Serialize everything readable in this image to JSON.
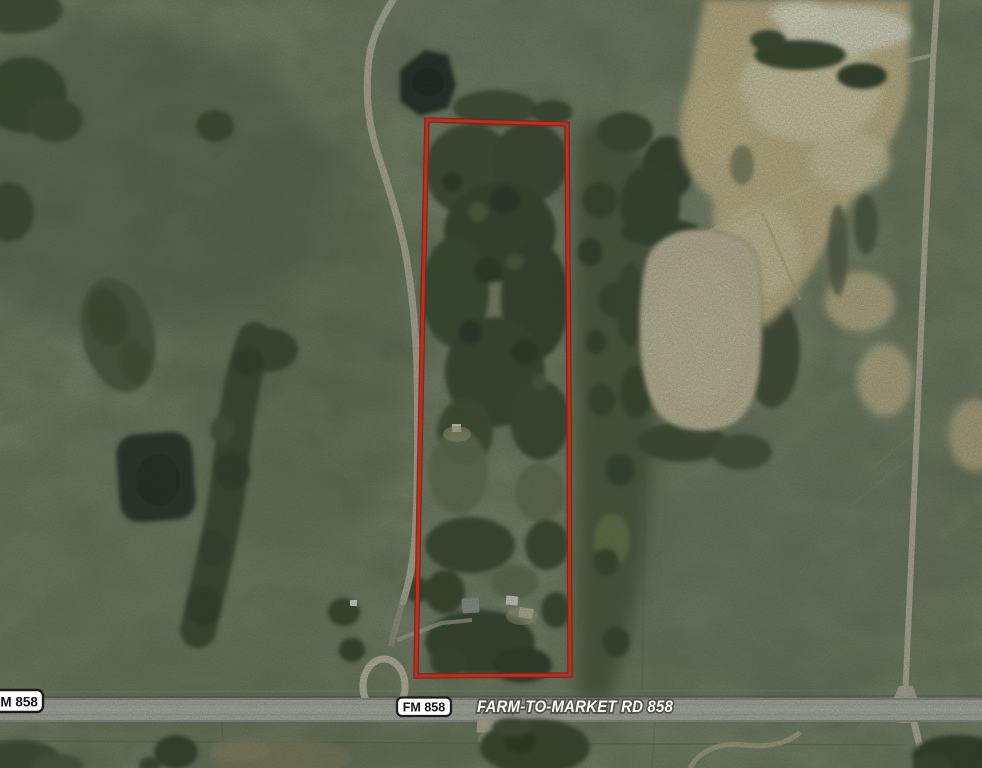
{
  "map": {
    "image_type": "aerial-satellite-photo",
    "road_name_label": "FARM-TO-MARKET RD 858",
    "route_shields": {
      "left": {
        "label": "FM 858"
      },
      "center": {
        "label": "FM 858"
      }
    },
    "colors": {
      "parcel_outline": "#f5261a",
      "parcel_outline_shadow": "#a81006",
      "shield_background": "#fdfdfd",
      "shield_border": "#1c1c1c",
      "shield_text": "#141414",
      "road_label_fill": "#fbfbf6",
      "road_label_halo": "#4e4e48",
      "highway_surface": "#b1b0aa",
      "grass_base": "#5c6753",
      "forest": "#33412d",
      "quarry_sand": "#c7b68d",
      "silt_pond": "#c8bda3",
      "stock_pond": "#1f2722"
    },
    "features": {
      "boundary": "red-parcel-outline",
      "highway": "farm-to-market-road-858",
      "quarry": "sand-pit",
      "silt_pond": "tan-silt-pond",
      "stock_ponds": "dark-stock-ponds"
    }
  }
}
